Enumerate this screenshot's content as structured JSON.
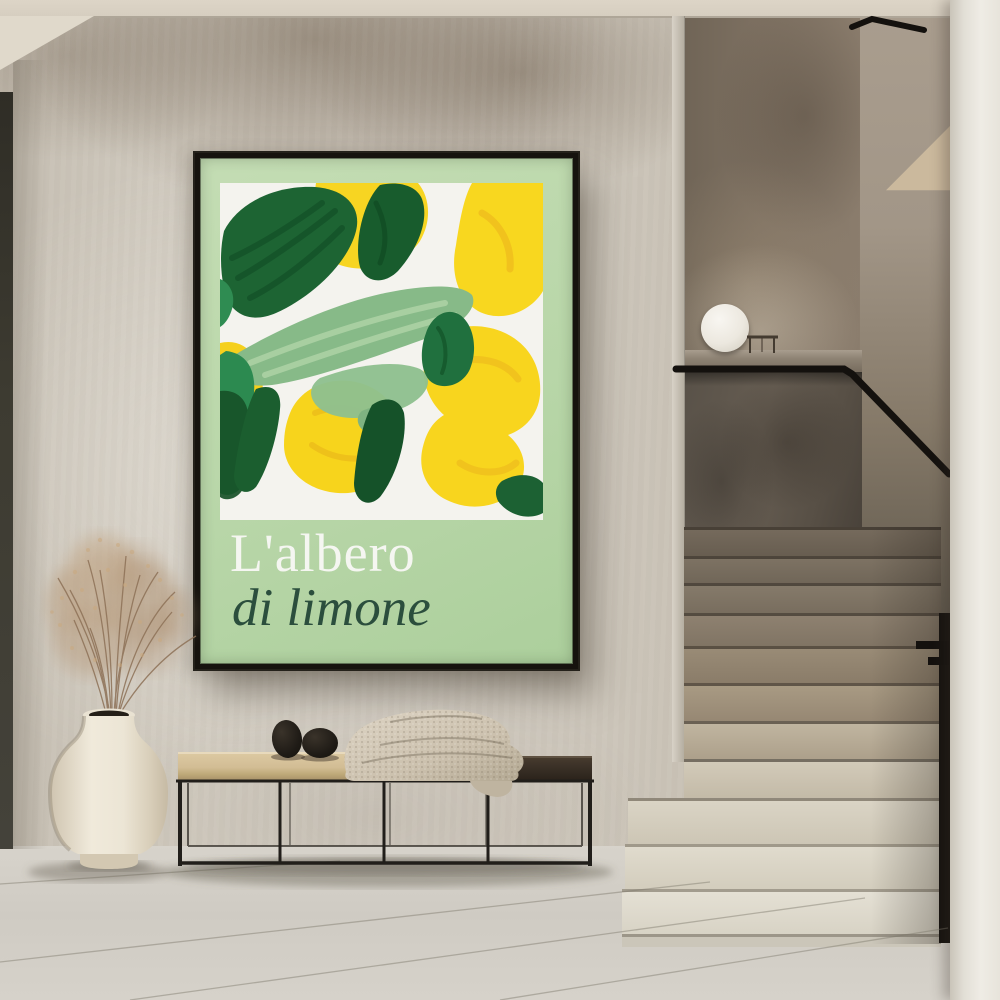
{
  "poster": {
    "title_line1": "L'albero",
    "title_line2": "di limone"
  },
  "palette": {
    "poster-green": "#b8d6a8",
    "title-white": "#f5f6f1",
    "subtitle-green": "#2b4e3d",
    "art-yellow": "#f7d522",
    "art-dark-green": "#1c6433",
    "art-sage": "#87ba88",
    "frame": "#16130e",
    "wall": "#ccc5ba",
    "ceiling": "#d6cec0",
    "floor": "#cfcbc3",
    "column": "#efece5",
    "lamp": "#ece8df",
    "bench-wood": "#d2bd94",
    "bench-dark": "#3c3228",
    "blanket": "#ccc1ae",
    "stone-black": "#1f1b16",
    "vase-ivory": "#ece5d6",
    "grass-tan": "#b59878",
    "handrail-black": "#14110e",
    "step-light": "#e1dcd0",
    "step-dark": "#6b6154"
  }
}
